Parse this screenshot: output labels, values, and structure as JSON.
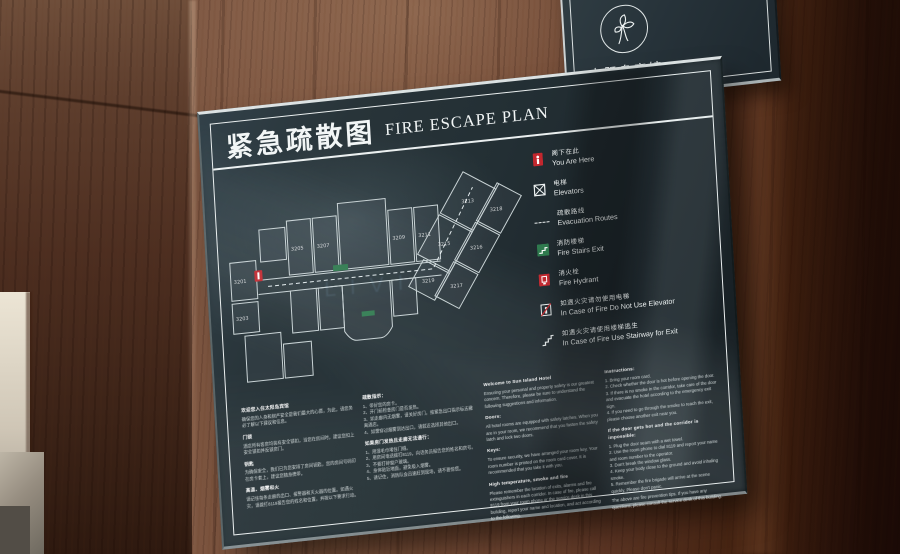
{
  "logo_sign": {
    "hotel_name_cn": "太阳岛宾馆",
    "hotel_name_en": "SUN ISLAND HOTEL"
  },
  "sign": {
    "title_cn": "紧急疏散图",
    "title_en": "FIRE ESCAPE PLAN",
    "colors": {
      "panel": "#243238",
      "frame": "#f2f6f6",
      "red": "#c2272e",
      "green": "#2f7a4e"
    },
    "legend": [
      {
        "cn": "阁下在此",
        "en": "You Are Here"
      },
      {
        "cn": "电梯",
        "en": "Elevators"
      },
      {
        "cn": "疏散路线",
        "en": "Evacuation Routes"
      },
      {
        "cn": "消防楼梯",
        "en": "Fire Stairs Exit"
      },
      {
        "cn": "消火栓",
        "en": "Fire Hydrant"
      },
      {
        "cn": "如遇火灾请勿使用电梯",
        "en": "In Case of Fire Do Not Use Elevator"
      },
      {
        "cn": "如遇火灾请使用楼梯逃生",
        "en": "In Case of Fire Use Stairway for Exit"
      }
    ],
    "floor_plan": {
      "rooms": [
        "3201",
        "3203",
        "3205",
        "3207",
        "3209",
        "3211",
        "3213",
        "3215",
        "3216",
        "3217",
        "3218",
        "3219"
      ],
      "watermark": "LIVI"
    },
    "info_columns": {
      "cn1": {
        "title": "欢迎您入住太阳岛宾馆",
        "intro": "确保您的人身和财产安全是我们最大的心愿，为此，请您务必了解以下建议和信息。",
        "sections": [
          {
            "h": "门锁",
            "t": "酒店所有客房均装有安全锁扣，当您在房间时，建议您扣上安全锁扣并反锁房门。"
          },
          {
            "h": "钥匙",
            "t": "为确保安全，我们已为您安排了房间钥匙，您的房间号码印在房卡套上，建议您随身携带。"
          },
          {
            "h": "高温、烟雾和火",
            "t": "请记住每条走廊的出口、报警器和灭火器的位置。如遇火灾，请拨打8119报告您的姓名和位置，并按以下要求行动。"
          }
        ]
      },
      "cn2": {
        "groups": [
          {
            "h": "疏散指示：",
            "t": "1、带好您的房卡。\n2、开门前检查房门是否发热。\n3、如走廊内无烟雾，请关好房门，按紧急出口指示标志撤离酒店。\n4、如需穿过烟雾到达出口，请就近选择其他出口。"
          },
          {
            "h": "如果房门发热且走廊无法通行：",
            "t": "1、用湿毛巾堵住门缝。\n2、用房间电话拨打8119，向话务员报告您的姓名和房号。\n3、不要打碎窗户玻璃。\n4、身体贴近地面，避免吸入烟雾。\n5、请记住，消防队会迅速赶到现场，请不要惊慌。"
          }
        ]
      },
      "en1": {
        "title": "Welcome to Sun Island Hotel",
        "intro": "Ensuring your personal and property safety is our greatest concern. Therefore, please be sure to understand the following suggestions and information.",
        "sections": [
          {
            "h": "Doors:",
            "t": "All hotel rooms are equipped with safety latches. When you are in your room, we recommend that you fasten the safety latch and lock two doors."
          },
          {
            "h": "Keys:",
            "t": "To ensure security, we have arranged your room key. Your room number is printed on the room card cover. It is recommended that you take it with you."
          },
          {
            "h": "High temperature, smoke and fire",
            "t": "Please remember the location of exits, alarms and fire extinguishers in each corridor. In case of fire, please call 8119 from your room phone or the service desk in this building, report your name and location, and act according to the following."
          }
        ]
      },
      "en2": {
        "groups": [
          {
            "h": "Instructions:",
            "t": "1. Bring your room card.\n2. Check whether the door is hot before opening the door.\n3. If there is no smoke in the corridor, take care of the door and evacuate the hotel according to the emergency exit sign.\n4. If you need to go through the smoke to reach the exit, please choose another exit near you."
          },
          {
            "h": "If the door gets hot and the corridor is impossible:",
            "t": "1. Plug the door seam with a wet towel.\n2. Use the room phone to dial 8119 and report your name and room number to the operator.\n3. Don't break the window glass.\n4. Keep your body close to the ground and avoid inhaling smoke.\n5. Remember the fire brigade will arrive at the scene quickly. Please don't panic."
          },
          {
            "h": "",
            "t": "The above are fire prevention tips. If you have any questions, please consult the service desk of this building."
          }
        ]
      }
    }
  }
}
